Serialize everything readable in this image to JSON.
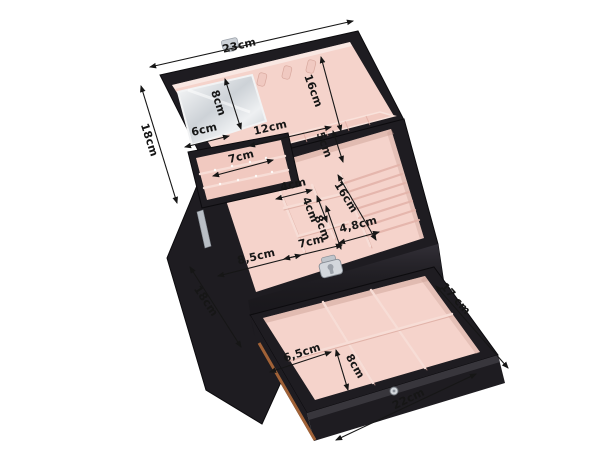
{
  "product_diagram": {
    "description_label": "jewelry-box-dimension-diagram",
    "dimensions": {
      "lid_width": "23cm",
      "lid_side": "18cm",
      "mirror_height": "8cm",
      "mirror_width": "6cm",
      "lid_interior_height": "16cm",
      "lid_pocket_width": "12cm",
      "lid_pocket_depth": "5cm",
      "earring_tray_width": "7cm",
      "small_compartment_width": "4cm",
      "small_compartment_depth": "4cm",
      "ring_roll_length": "16cm",
      "middle_section_depth": "8cm",
      "ring_roll_width": "4,8cm",
      "front_compartment_width": "7cm",
      "left_compartment_width": "8,5cm",
      "case_side_depth": "18cm",
      "drawer_depth": "17 cm",
      "drawer_compartment_width": "6,5cm",
      "drawer_compartment_depth": "8cm",
      "drawer_width": "22cm"
    },
    "colors": {
      "background": "#ffffff",
      "case_black": "#1e1c21",
      "lining_pink": "#f5d3cb",
      "lining_pink_deep": "#f1c9c0",
      "dimension_ink": "#161616",
      "metal": "#d3d7dc",
      "wood_edge": "#b06a3a"
    }
  }
}
